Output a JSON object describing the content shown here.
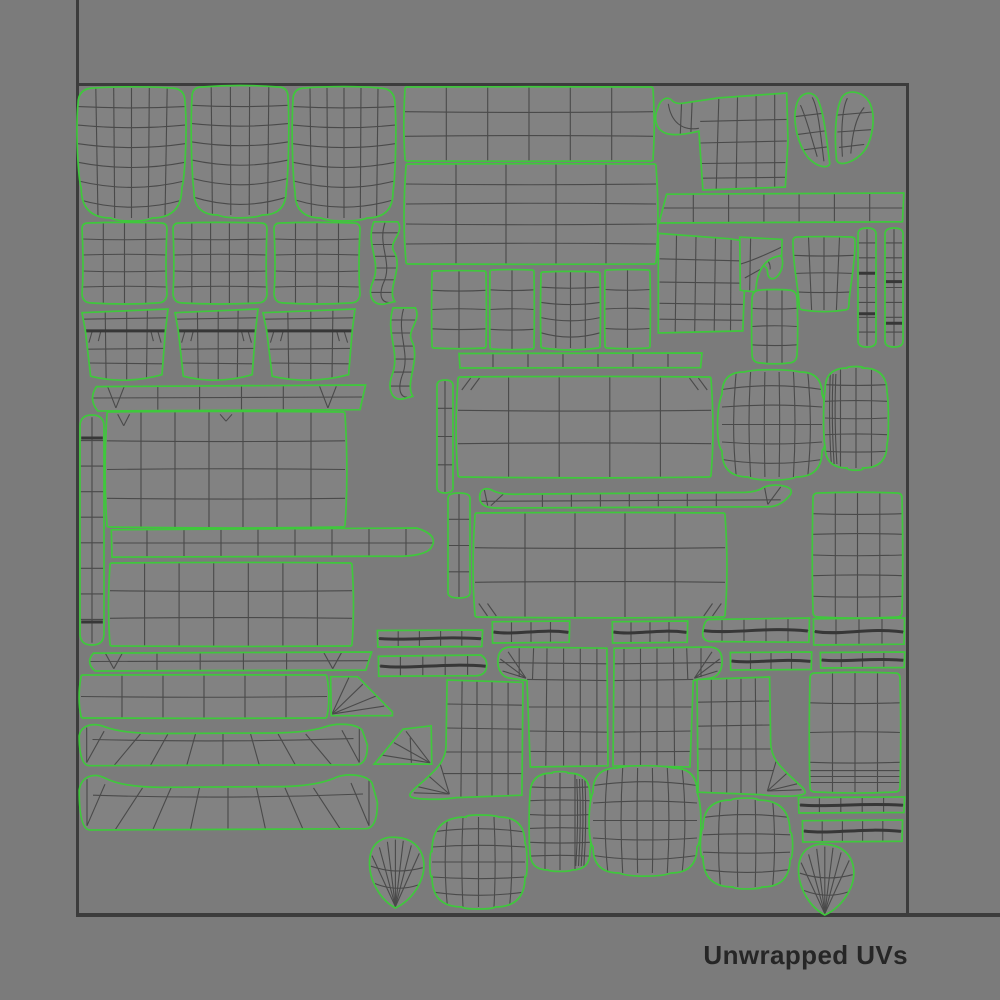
{
  "caption": {
    "label": "Unwrapped UVs",
    "color": "#262626"
  },
  "canvas": {
    "background": "#7b7b7b",
    "island_fill": "#828282",
    "outline_color": "#3fc83c",
    "wire_color": "#4a4a4a",
    "wire_bold": "#373737",
    "border_color": "#3c3c3c",
    "uv_square": {
      "x1": 77,
      "y1": 84,
      "x2": 907,
      "y2": 914
    }
  },
  "islands": [
    {
      "name": "seat-cushion-a",
      "type": "organic",
      "x": 78,
      "y": 88,
      "w": 107,
      "h": 130,
      "cols": 6,
      "rows": 7,
      "r": [
        16,
        14,
        30,
        30
      ],
      "bulge": [
        0.012,
        0.025,
        0.03,
        0.025
      ],
      "bow": "down",
      "taper": 0.03
    },
    {
      "name": "seat-cushion-b",
      "type": "organic",
      "x": 192,
      "y": 87,
      "w": 96,
      "h": 128,
      "cols": 5,
      "rows": 7,
      "r": [
        10,
        10,
        24,
        24
      ],
      "bulge": [
        0.015,
        0.02,
        0.03,
        0.02
      ],
      "bow": "down",
      "taper": 0.02
    },
    {
      "name": "seat-cushion-c",
      "type": "organic",
      "x": 293,
      "y": 88,
      "w": 102,
      "h": 130,
      "cols": 6,
      "rows": 7,
      "r": [
        12,
        16,
        26,
        26
      ],
      "bulge": [
        0.015,
        0.02,
        0.03,
        0.02
      ],
      "bow": "down",
      "taper": 0.02
    },
    {
      "name": "back-panel-top",
      "type": "organic",
      "x": 405,
      "y": 87,
      "w": 248,
      "h": 74,
      "cols": 6,
      "rows": 3,
      "r": 2,
      "bulge": [
        0.004,
        0.006,
        0.004,
        0.006
      ]
    },
    {
      "name": "back-panel-mid",
      "type": "organic",
      "x": 406,
      "y": 164,
      "w": 250,
      "h": 100,
      "cols": 5,
      "rows": 5,
      "r": 2,
      "bulge": [
        0.004,
        0.01,
        0.004,
        0.01
      ]
    },
    {
      "name": "arm-hook-left",
      "type": "hookL",
      "x": 655,
      "y": 92,
      "w": 133,
      "h": 98
    },
    {
      "name": "rail-bar",
      "type": "bar",
      "x": 658,
      "y": 193,
      "w": 247,
      "h": 30,
      "cols": 7,
      "rows": 2,
      "end": "chamferL"
    },
    {
      "name": "arm-hook-right",
      "type": "hookR",
      "x": 657,
      "y": 227,
      "w": 130,
      "h": 106
    },
    {
      "name": "wing-pair",
      "type": "wings",
      "x": 792,
      "y": 92,
      "w": 84,
      "h": 77
    },
    {
      "name": "ladder-strip-a",
      "type": "ladder",
      "x": 858,
      "y": 228,
      "w": 18,
      "h": 119,
      "rungs": 7,
      "marks": [
        0.38,
        0.72
      ]
    },
    {
      "name": "ladder-strip-b",
      "type": "ladder",
      "x": 885,
      "y": 228,
      "w": 18,
      "h": 119,
      "rungs": 7,
      "marks": [
        0.45,
        0.8
      ]
    },
    {
      "name": "side-panel-small",
      "type": "organic",
      "x": 793,
      "y": 237,
      "w": 62,
      "h": 73,
      "cols": 4,
      "rows": 4,
      "r": 4,
      "taper": 0.1,
      "bulge": [
        0.008,
        0.01,
        0.03,
        0.01
      ]
    },
    {
      "name": "corner-elbow",
      "type": "elbow",
      "x": 738,
      "y": 236,
      "w": 45,
      "h": 56
    },
    {
      "name": "corner-square",
      "type": "organic",
      "x": 752,
      "y": 290,
      "w": 45,
      "h": 73,
      "cols": 3,
      "rows": 4,
      "r": 9,
      "bulge": [
        0.01,
        0.02,
        0.015,
        0.01
      ]
    },
    {
      "name": "back-pillow-a",
      "type": "organic",
      "x": 82,
      "y": 223,
      "w": 85,
      "h": 80,
      "cols": 4,
      "rows": 5,
      "r": [
        6,
        6,
        10,
        10
      ],
      "bulge": [
        0.01,
        -0.015,
        0.015,
        -0.015
      ]
    },
    {
      "name": "back-pillow-b",
      "type": "organic",
      "x": 173,
      "y": 223,
      "w": 94,
      "h": 80,
      "cols": 5,
      "rows": 5,
      "r": [
        6,
        6,
        10,
        10
      ],
      "bulge": [
        0.01,
        -0.012,
        0.015,
        -0.012
      ]
    },
    {
      "name": "back-pillow-c",
      "type": "organic",
      "x": 274,
      "y": 223,
      "w": 86,
      "h": 80,
      "cols": 4,
      "rows": 5,
      "r": [
        6,
        6,
        10,
        10
      ],
      "bulge": [
        0.01,
        -0.015,
        0.015,
        -0.015
      ]
    },
    {
      "name": "s-strip-a",
      "type": "sstrip",
      "x": 365,
      "y": 221,
      "w": 40,
      "h": 84
    },
    {
      "name": "arm-front-a",
      "type": "armfront",
      "x": 82,
      "y": 309,
      "w": 86,
      "h": 73
    },
    {
      "name": "arm-front-b",
      "type": "armfront",
      "x": 175,
      "y": 309,
      "w": 83,
      "h": 73
    },
    {
      "name": "arm-front-c",
      "type": "armfront",
      "x": 263,
      "y": 309,
      "w": 92,
      "h": 73
    },
    {
      "name": "s-strip-b",
      "type": "sstrip",
      "x": 385,
      "y": 307,
      "w": 37,
      "h": 93
    },
    {
      "name": "base-notch-bar",
      "type": "notchbar",
      "x": 88,
      "y": 385,
      "w": 279,
      "h": 26
    },
    {
      "name": "side-ladder",
      "type": "ladder",
      "x": 80,
      "y": 415,
      "w": 24,
      "h": 230,
      "rungs": 8,
      "marks": [
        0.1,
        0.9
      ]
    },
    {
      "name": "frame-rect-a",
      "type": "organic",
      "x": 107,
      "y": 412,
      "w": 238,
      "h": 115,
      "cols": 7,
      "rows": 4,
      "r": 2,
      "darts": [
        [
          0.07,
          0.12
        ],
        [
          0.5,
          0.08
        ]
      ]
    },
    {
      "name": "taper-rail",
      "type": "bar",
      "x": 110,
      "y": 528,
      "w": 333,
      "h": 30,
      "cols": 9,
      "rows": 2,
      "end": "pointR"
    },
    {
      "name": "frame-rect-b",
      "type": "organic",
      "x": 110,
      "y": 563,
      "w": 242,
      "h": 83,
      "cols": 7,
      "rows": 3,
      "r": 2,
      "bulge": [
        0.01,
        0.008,
        0.008,
        0.008
      ]
    },
    {
      "name": "skirt-notch-bar",
      "type": "notchbar",
      "x": 85,
      "y": 652,
      "w": 288,
      "h": 19
    },
    {
      "name": "front-rail",
      "type": "organic",
      "x": 81,
      "y": 675,
      "w": 246,
      "h": 43,
      "cols": 6,
      "rows": 2,
      "r": 2
    },
    {
      "name": "wedge-a",
      "type": "wedgeA",
      "x": 330,
      "y": 675,
      "w": 63,
      "h": 42
    },
    {
      "name": "skirt-band-a",
      "type": "skirt",
      "x": 78,
      "y": 722,
      "w": 290,
      "h": 46
    },
    {
      "name": "wedge-b",
      "type": "wedgeB",
      "x": 373,
      "y": 725,
      "w": 60,
      "h": 42
    },
    {
      "name": "skirt-band-b",
      "type": "skirt",
      "x": 78,
      "y": 772,
      "w": 300,
      "h": 61
    },
    {
      "name": "pipe-bar-a",
      "type": "pipebar",
      "x": 377,
      "y": 630,
      "w": 106,
      "h": 17,
      "cols": 5,
      "rows": 2
    },
    {
      "name": "pipe-bar-b",
      "type": "pipebar",
      "x": 378,
      "y": 655,
      "w": 112,
      "h": 22,
      "cols": 5,
      "rows": 2,
      "end": "pointR"
    },
    {
      "name": "small-rect-a",
      "type": "organic",
      "x": 432,
      "y": 271,
      "w": 54,
      "h": 77,
      "cols": 2,
      "rows": 4,
      "r": 2
    },
    {
      "name": "small-rect-b",
      "type": "organic",
      "x": 490,
      "y": 270,
      "w": 44,
      "h": 79,
      "cols": 2,
      "rows": 4,
      "r": 2
    },
    {
      "name": "small-rect-c",
      "type": "organic",
      "x": 541,
      "y": 272,
      "w": 59,
      "h": 76,
      "cols": 4,
      "rows": 5,
      "r": 2,
      "bulge": [
        0.01,
        0.01,
        0.035,
        0.01
      ],
      "bow": "down"
    },
    {
      "name": "small-rect-d",
      "type": "organic",
      "x": 605,
      "y": 270,
      "w": 45,
      "h": 78,
      "cols": 2,
      "rows": 4,
      "r": 2
    },
    {
      "name": "thin-rail",
      "type": "bar",
      "x": 458,
      "y": 353,
      "w": 245,
      "h": 15,
      "cols": 7,
      "rows": 1
    },
    {
      "name": "center-rect-a",
      "type": "organic",
      "x": 458,
      "y": 377,
      "w": 253,
      "h": 100,
      "cols": 5,
      "rows": 3,
      "r": 2,
      "notches": [
        "tl",
        "tr"
      ]
    },
    {
      "name": "v-strip-a",
      "type": "ladder",
      "x": 437,
      "y": 380,
      "w": 16,
      "h": 113,
      "rungs": 3
    },
    {
      "name": "v-strip-b",
      "type": "ladder",
      "x": 448,
      "y": 493,
      "w": 22,
      "h": 105,
      "rungs": 3
    },
    {
      "name": "fan-rail",
      "type": "fanbar",
      "x": 478,
      "y": 484,
      "w": 322,
      "h": 24
    },
    {
      "name": "center-rect-b",
      "type": "organic",
      "x": 475,
      "y": 513,
      "w": 250,
      "h": 104,
      "cols": 5,
      "rows": 3,
      "r": 2,
      "notches": [
        "bl",
        "br"
      ]
    },
    {
      "name": "right-rect-a",
      "type": "organic",
      "x": 813,
      "y": 493,
      "w": 89,
      "h": 124,
      "cols": 4,
      "rows": 6,
      "r": 5
    },
    {
      "name": "barrel-a",
      "type": "organic",
      "x": 722,
      "y": 372,
      "w": 100,
      "h": 105,
      "cols": 7,
      "rows": 6,
      "r": [
        22,
        22,
        26,
        26
      ],
      "bulge": [
        0.03,
        0.06,
        0.04,
        0.06
      ],
      "bow": "barrel"
    },
    {
      "name": "blob-tall-right",
      "type": "organic",
      "x": 825,
      "y": 368,
      "w": 62,
      "h": 100,
      "cols": 4,
      "rows": 6,
      "r": [
        22,
        24,
        24,
        22
      ],
      "bulge": [
        0.02,
        0.03,
        0.03,
        0.03
      ],
      "denseLeft": 3
    },
    {
      "name": "pipe-bar-c",
      "type": "pipebar",
      "x": 492,
      "y": 621,
      "w": 78,
      "h": 22,
      "cols": 4,
      "rows": 2
    },
    {
      "name": "pipe-bar-d",
      "type": "pipebar",
      "x": 612,
      "y": 621,
      "w": 76,
      "h": 22,
      "cols": 4,
      "rows": 2
    },
    {
      "name": "pipe-bar-e",
      "type": "pipebar",
      "x": 700,
      "y": 618,
      "w": 110,
      "h": 25,
      "cols": 5,
      "rows": 2,
      "end": "pointL"
    },
    {
      "name": "pipe-bar-f",
      "type": "pipebar",
      "x": 813,
      "y": 618,
      "w": 92,
      "h": 27,
      "cols": 4,
      "rows": 2
    },
    {
      "name": "pipe-bar-g",
      "type": "pipebar",
      "x": 730,
      "y": 652,
      "w": 82,
      "h": 18,
      "cols": 4,
      "rows": 2
    },
    {
      "name": "pipe-bar-h",
      "type": "pipebar",
      "x": 820,
      "y": 652,
      "w": 85,
      "h": 16,
      "cols": 4,
      "rows": 2
    },
    {
      "name": "tshirt-left",
      "type": "tshirtL",
      "x": 497,
      "y": 647,
      "w": 111,
      "h": 120
    },
    {
      "name": "tshirt-right",
      "type": "tshirtR",
      "x": 613,
      "y": 647,
      "w": 110,
      "h": 120
    },
    {
      "name": "boot-left",
      "type": "bootL",
      "x": 408,
      "y": 680,
      "w": 115,
      "h": 120
    },
    {
      "name": "boot-right",
      "type": "bootR",
      "x": 697,
      "y": 677,
      "w": 110,
      "h": 120
    },
    {
      "name": "right-rect-b",
      "type": "organic",
      "x": 810,
      "y": 673,
      "w": 90,
      "h": 119,
      "cols": 4,
      "rows": 4,
      "r": 5,
      "denseBottom": 3
    },
    {
      "name": "pipe-bar-i",
      "type": "pipebar",
      "x": 798,
      "y": 797,
      "w": 107,
      "h": 16,
      "cols": 5,
      "rows": 2
    },
    {
      "name": "pipe-bar-j",
      "type": "pipebar",
      "x": 802,
      "y": 820,
      "w": 101,
      "h": 22,
      "cols": 5,
      "rows": 2
    },
    {
      "name": "teardrop-a",
      "type": "teardrop",
      "x": 368,
      "y": 836,
      "w": 57,
      "h": 72
    },
    {
      "name": "blob-a",
      "type": "organic",
      "x": 432,
      "y": 817,
      "w": 93,
      "h": 90,
      "cols": 6,
      "rows": 6,
      "r": [
        34,
        26,
        30,
        30
      ],
      "bulge": [
        0.03,
        0.03,
        0.03,
        0.03
      ],
      "bow": "barrel"
    },
    {
      "name": "round-tall",
      "type": "organic",
      "x": 530,
      "y": 773,
      "w": 60,
      "h": 97,
      "cols": 4,
      "rows": 7,
      "r": [
        22,
        22,
        18,
        18
      ],
      "bulge": [
        0.02,
        0.025,
        0.02,
        0.02
      ],
      "denseRight": 4
    },
    {
      "name": "barrel-b",
      "type": "organic",
      "x": 593,
      "y": 768,
      "w": 104,
      "h": 105,
      "cols": 7,
      "rows": 6,
      "r": [
        24,
        24,
        26,
        26
      ],
      "bulge": [
        0.03,
        0.05,
        0.04,
        0.05
      ],
      "bow": "barrel"
    },
    {
      "name": "blob-b",
      "type": "organic",
      "x": 703,
      "y": 800,
      "w": 87,
      "h": 87,
      "cols": 5,
      "rows": 5,
      "r": [
        28,
        32,
        28,
        30
      ],
      "bulge": [
        0.03,
        0.04,
        0.03,
        0.04
      ],
      "bow": "barrel"
    },
    {
      "name": "teardrop-b",
      "type": "teardrop",
      "x": 797,
      "y": 843,
      "w": 58,
      "h": 72
    }
  ]
}
